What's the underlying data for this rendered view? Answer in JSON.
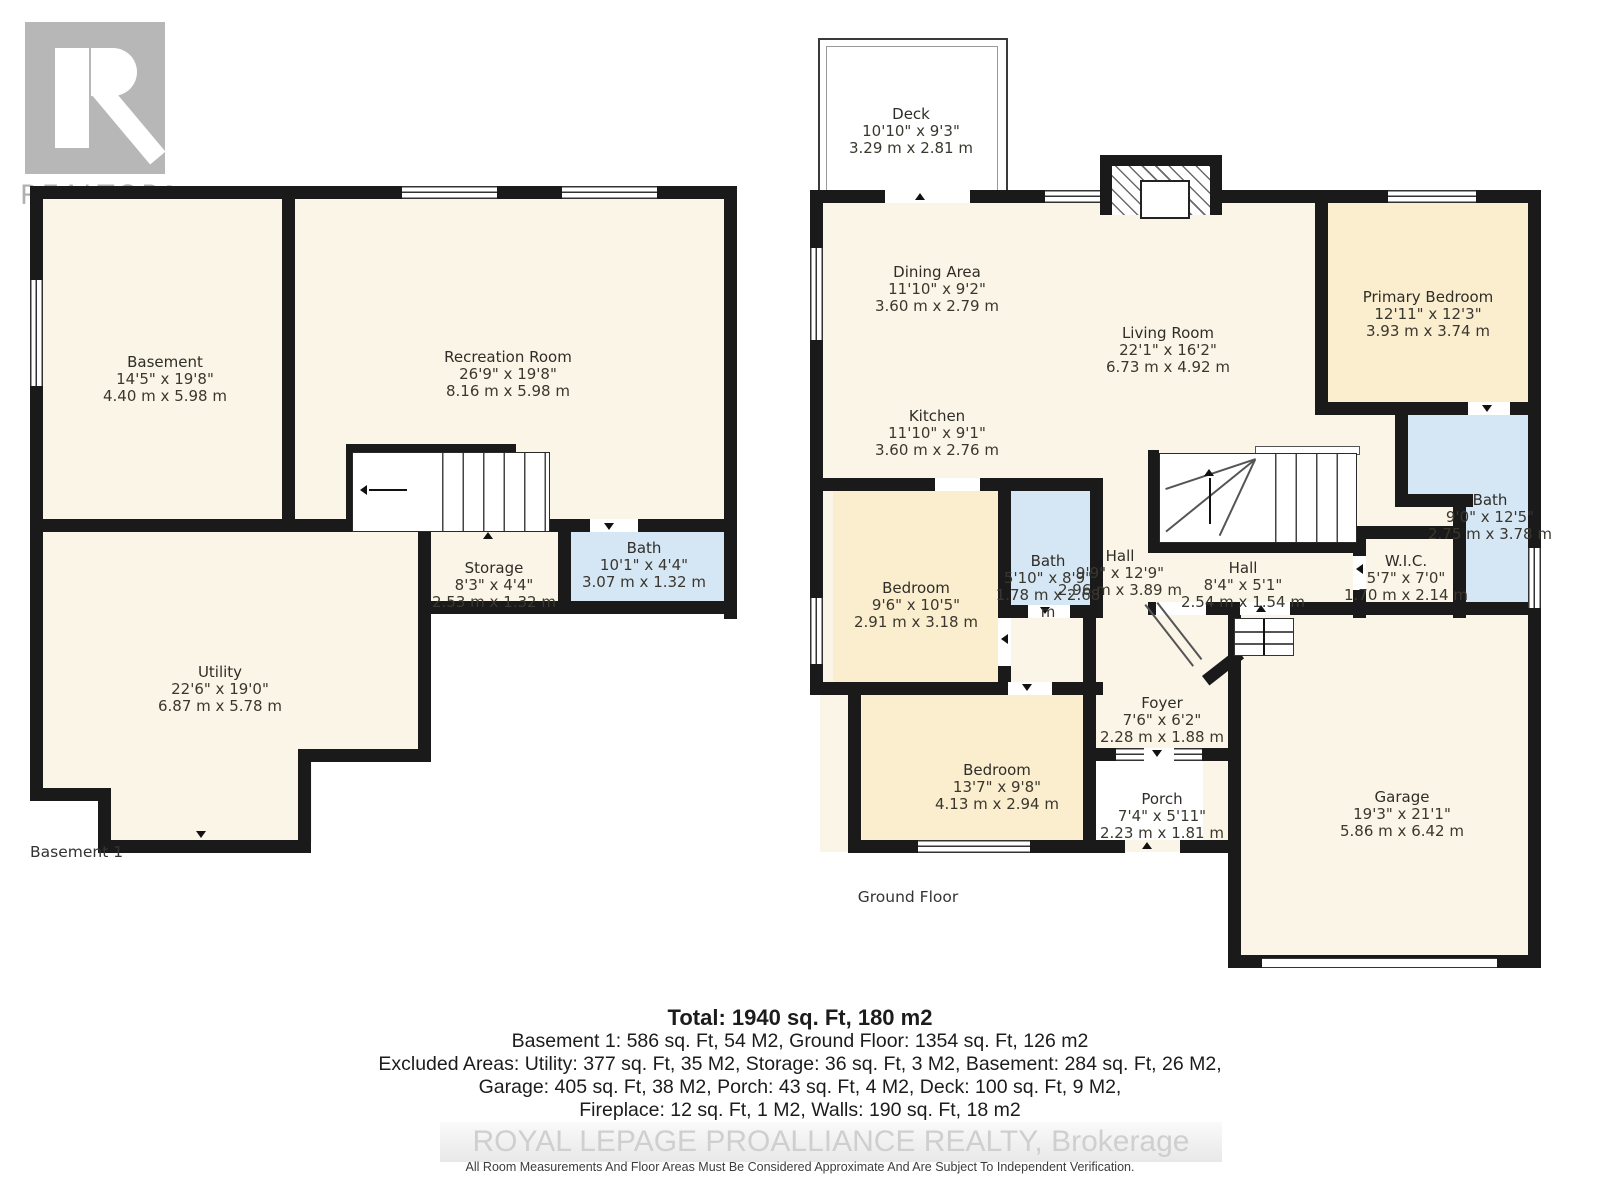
{
  "logo": {
    "label": "REALTOR",
    "reg": "®"
  },
  "floors": {
    "basement": {
      "title": "Basement 1",
      "rooms": {
        "basement": {
          "name": "Basement",
          "imperial": "14'5\" x 19'8\"",
          "metric": "4.40 m x 5.98 m"
        },
        "recreation": {
          "name": "Recreation Room",
          "imperial": "26'9\" x 19'8\"",
          "metric": "8.16 m x 5.98 m"
        },
        "storage": {
          "name": "Storage",
          "imperial": "8'3\" x 4'4\"",
          "metric": "2.53 m x 1.32 m"
        },
        "bath": {
          "name": "Bath",
          "imperial": "10'1\" x 4'4\"",
          "metric": "3.07 m x 1.32 m"
        },
        "utility": {
          "name": "Utility",
          "imperial": "22'6\" x 19'0\"",
          "metric": "6.87 m x 5.78 m"
        }
      }
    },
    "ground": {
      "title": "Ground Floor",
      "rooms": {
        "deck": {
          "name": "Deck",
          "imperial": "10'10\" x 9'3\"",
          "metric": "3.29 m x 2.81 m"
        },
        "dining": {
          "name": "Dining Area",
          "imperial": "11'10\" x 9'2\"",
          "metric": "3.60 m x 2.79 m"
        },
        "living": {
          "name": "Living Room",
          "imperial": "22'1\" x 16'2\"",
          "metric": "6.73 m x 4.92 m"
        },
        "kitchen": {
          "name": "Kitchen",
          "imperial": "11'10\" x 9'1\"",
          "metric": "3.60 m x 2.76 m"
        },
        "primary": {
          "name": "Primary Bedroom",
          "imperial": "12'11\" x 12'3\"",
          "metric": "3.93 m x 3.74 m"
        },
        "bath_top": {
          "name": "Bath",
          "imperial": "9'0\" x 12'5\"",
          "metric": "2.75 m x 3.78 m"
        },
        "bath_mid": {
          "name": "Bath",
          "imperial": "5'10\" x 8'9\"",
          "metric": "1.78 m x 2.68 m"
        },
        "hall_main": {
          "name": "Hall",
          "imperial": "9'9\" x 12'9\"",
          "metric": "2.96 m x 3.89 m"
        },
        "hall_small": {
          "name": "Hall",
          "imperial": "8'4\" x 5'1\"",
          "metric": "2.54 m x 1.54 m"
        },
        "wic": {
          "name": "W.I.C.",
          "imperial": "5'7\" x 7'0\"",
          "metric": "1.70 m x 2.14 m"
        },
        "bedroom1": {
          "name": "Bedroom",
          "imperial": "9'6\" x 10'5\"",
          "metric": "2.91 m x 3.18 m"
        },
        "bedroom2": {
          "name": "Bedroom",
          "imperial": "13'7\" x 9'8\"",
          "metric": "4.13 m x 2.94 m"
        },
        "foyer": {
          "name": "Foyer",
          "imperial": "7'6\" x 6'2\"",
          "metric": "2.28 m x 1.88 m"
        },
        "porch": {
          "name": "Porch",
          "imperial": "7'4\" x 5'11\"",
          "metric": "2.23 m x 1.81 m"
        },
        "garage": {
          "name": "Garage",
          "imperial": "19'3\" x 21'1\"",
          "metric": "5.86 m x 6.42 m"
        }
      }
    }
  },
  "summary": {
    "total": "Total: 1940 sq. Ft, 180 m2",
    "line2": "Basement 1: 586 sq. Ft, 54 M2, Ground Floor: 1354 sq. Ft, 126 m2",
    "line3": "Excluded Areas: Utility: 377 sq. Ft, 35 M2, Storage: 36 sq. Ft, 3 M2, Basement: 284 sq. Ft, 26 M2,",
    "line4": "Garage: 405 sq. Ft, 38 M2, Porch: 43 sq. Ft, 4 M2, Deck: 100 sq. Ft, 9 M2,",
    "line5": "Fireplace: 12 sq. Ft, 1 M2, Walls: 190 sq. Ft, 18 m2"
  },
  "watermark": "ROYAL LEPAGE PROALLIANCE REALTY, Brokerage",
  "disclaimer": "All Room Measurements And Floor Areas Must Be Considered Approximate And Are Subject To Independent Verification.",
  "colors": {
    "wall": "#1a1a1a",
    "room": "#faf5e6",
    "bedroom": "#fbeecf",
    "bath": "#d5e6f5",
    "logo_gray": "#b7b7b7"
  }
}
